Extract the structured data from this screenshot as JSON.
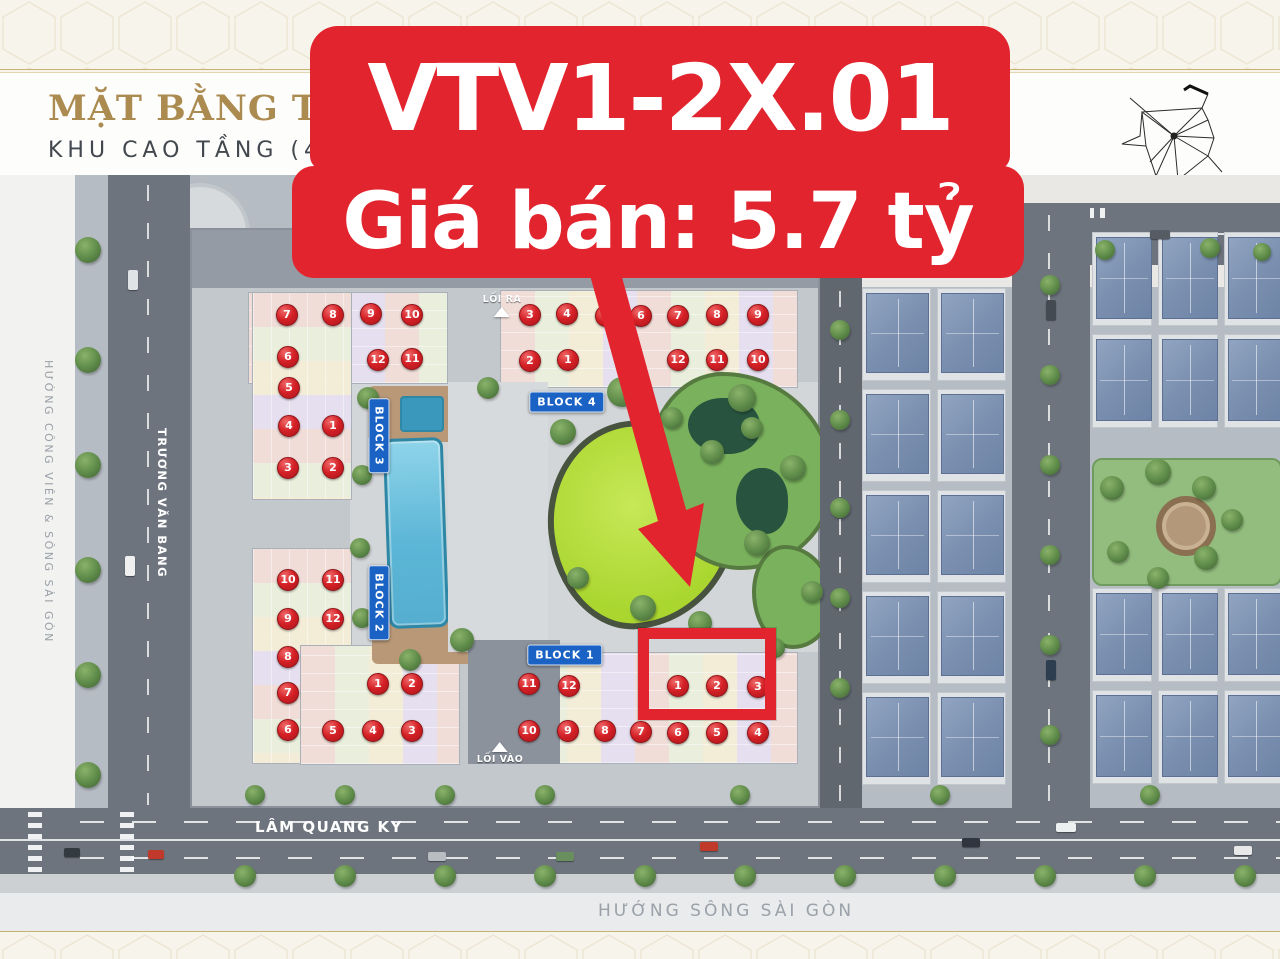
{
  "header": {
    "title": "MẶT BẰNG TỔNG T",
    "subtitle": "KHU CAO TẦNG (4-24)"
  },
  "banner": {
    "line1": "VTV1-2X.01",
    "line2": "Giá bán: 5.7 tỷ",
    "bg_color": "#e2242e",
    "text_color": "#ffffff"
  },
  "map": {
    "streets": {
      "left_label": "HƯỚNG CÔNG VIÊN & SÔNG SÀI GÒN",
      "left_vertical": "TRƯƠNG VĂN BANG",
      "bottom_horizontal": "LÂM QUANG KY",
      "bottom_label": "HƯỚNG SÔNG SÀI GÒN"
    },
    "entrances": [
      {
        "label": "LỐI RA",
        "x": 502,
        "y": 294,
        "triangle": "below"
      },
      {
        "label": "LỐI VÀO",
        "x": 500,
        "y": 742,
        "triangle": "above"
      }
    ],
    "blocks": [
      {
        "label": "BLOCK 3",
        "orientation": "vertical",
        "x": 379,
        "y": 436
      },
      {
        "label": "BLOCK 2",
        "orientation": "vertical",
        "x": 379,
        "y": 603
      },
      {
        "label": "BLOCK 4",
        "orientation": "horizontal",
        "x": 567,
        "y": 402
      },
      {
        "label": "BLOCK 1",
        "orientation": "horizontal",
        "x": 565,
        "y": 655
      }
    ],
    "unit_markers": [
      {
        "block": "B3",
        "n": 7,
        "x": 287,
        "y": 315
      },
      {
        "block": "B3",
        "n": 8,
        "x": 333,
        "y": 315
      },
      {
        "block": "B3",
        "n": 9,
        "x": 371,
        "y": 314
      },
      {
        "block": "B3",
        "n": 10,
        "x": 412,
        "y": 315
      },
      {
        "block": "B3",
        "n": 6,
        "x": 288,
        "y": 357
      },
      {
        "block": "B3",
        "n": 12,
        "x": 378,
        "y": 360
      },
      {
        "block": "B3",
        "n": 11,
        "x": 412,
        "y": 359
      },
      {
        "block": "B3",
        "n": 5,
        "x": 289,
        "y": 388
      },
      {
        "block": "B3",
        "n": 4,
        "x": 289,
        "y": 426
      },
      {
        "block": "B3",
        "n": 1,
        "x": 333,
        "y": 426
      },
      {
        "block": "B3",
        "n": 3,
        "x": 288,
        "y": 468
      },
      {
        "block": "B3",
        "n": 2,
        "x": 333,
        "y": 468
      },
      {
        "block": "B4",
        "n": 3,
        "x": 530,
        "y": 315
      },
      {
        "block": "B4",
        "n": 4,
        "x": 567,
        "y": 314
      },
      {
        "block": "B4",
        "n": 5,
        "x": 606,
        "y": 316
      },
      {
        "block": "B4",
        "n": 6,
        "x": 641,
        "y": 316
      },
      {
        "block": "B4",
        "n": 7,
        "x": 678,
        "y": 316
      },
      {
        "block": "B4",
        "n": 8,
        "x": 717,
        "y": 315
      },
      {
        "block": "B4",
        "n": 9,
        "x": 758,
        "y": 315
      },
      {
        "block": "B4",
        "n": 2,
        "x": 530,
        "y": 361
      },
      {
        "block": "B4",
        "n": 1,
        "x": 568,
        "y": 360
      },
      {
        "block": "B4",
        "n": 12,
        "x": 678,
        "y": 360
      },
      {
        "block": "B4",
        "n": 11,
        "x": 717,
        "y": 360
      },
      {
        "block": "B4",
        "n": 10,
        "x": 758,
        "y": 360
      },
      {
        "block": "B2",
        "n": 10,
        "x": 288,
        "y": 580
      },
      {
        "block": "B2",
        "n": 11,
        "x": 333,
        "y": 580
      },
      {
        "block": "B2",
        "n": 9,
        "x": 288,
        "y": 619
      },
      {
        "block": "B2",
        "n": 12,
        "x": 333,
        "y": 619
      },
      {
        "block": "B2",
        "n": 8,
        "x": 288,
        "y": 657
      },
      {
        "block": "B2",
        "n": 7,
        "x": 288,
        "y": 693
      },
      {
        "block": "B2",
        "n": 1,
        "x": 378,
        "y": 684
      },
      {
        "block": "B2",
        "n": 2,
        "x": 412,
        "y": 684
      },
      {
        "block": "B2",
        "n": 6,
        "x": 288,
        "y": 730
      },
      {
        "block": "B2",
        "n": 5,
        "x": 333,
        "y": 731
      },
      {
        "block": "B2",
        "n": 4,
        "x": 373,
        "y": 731
      },
      {
        "block": "B2",
        "n": 3,
        "x": 412,
        "y": 731
      },
      {
        "block": "B1",
        "n": 11,
        "x": 529,
        "y": 684
      },
      {
        "block": "B1",
        "n": 12,
        "x": 569,
        "y": 686
      },
      {
        "block": "B1",
        "n": 1,
        "x": 678,
        "y": 686
      },
      {
        "block": "B1",
        "n": 2,
        "x": 717,
        "y": 686
      },
      {
        "block": "B1",
        "n": 3,
        "x": 758,
        "y": 687
      },
      {
        "block": "B1",
        "n": 10,
        "x": 529,
        "y": 731
      },
      {
        "block": "B1",
        "n": 9,
        "x": 568,
        "y": 731
      },
      {
        "block": "B1",
        "n": 8,
        "x": 605,
        "y": 731
      },
      {
        "block": "B1",
        "n": 7,
        "x": 641,
        "y": 732
      },
      {
        "block": "B1",
        "n": 6,
        "x": 678,
        "y": 733
      },
      {
        "block": "B1",
        "n": 5,
        "x": 717,
        "y": 733
      },
      {
        "block": "B1",
        "n": 4,
        "x": 758,
        "y": 733
      }
    ],
    "highlight": {
      "rect": {
        "x": 638,
        "y": 628,
        "w": 138,
        "h": 92
      },
      "arrow_tip": {
        "x": 690,
        "y": 586
      },
      "color": "#e2242e"
    },
    "colors": {
      "marker_red": "#d42026",
      "block_blue": "#1a63c5",
      "pool_blue": "#5cb6d6",
      "lawn_green": "#aad62f",
      "banner_red": "#e2242e"
    }
  }
}
